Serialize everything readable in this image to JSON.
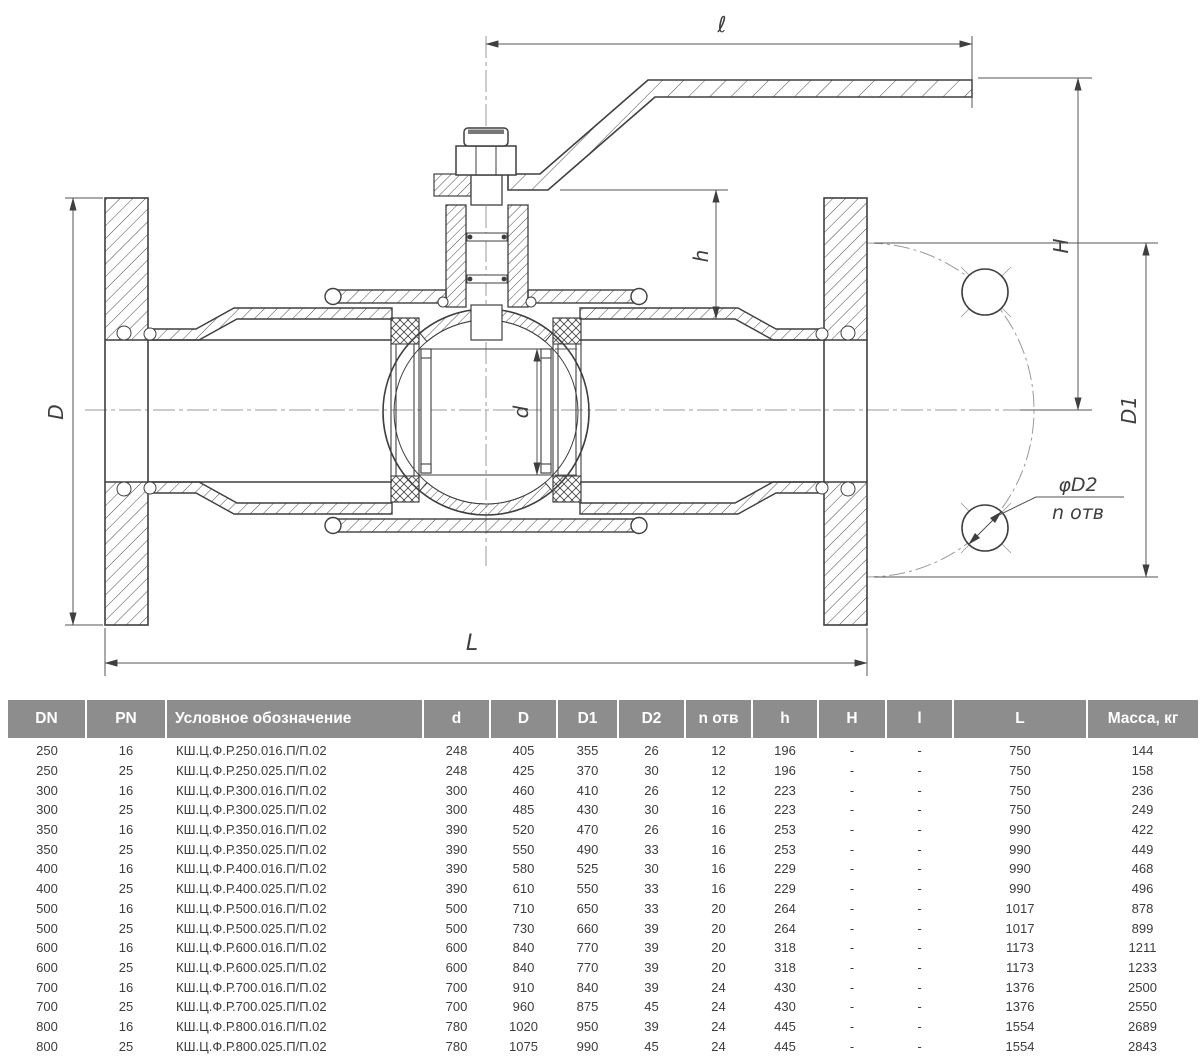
{
  "drawing": {
    "labels": {
      "l": "ℓ",
      "H": "H",
      "h": "h",
      "D": "D",
      "d": "d",
      "D1": "D1",
      "L": "L",
      "hole_note_1": "φD2",
      "hole_note_2": "n отв"
    },
    "line_color": "#3f3f3f",
    "dim_color": "#555555",
    "centerline_color": "#9a9a9a"
  },
  "table": {
    "header_bg": "#8d8d8d",
    "header_text_color": "#ffffff",
    "columns": [
      "DN",
      "PN",
      "Условное обозначение",
      "d",
      "D",
      "D1",
      "D2",
      "n отв",
      "h",
      "H",
      "l",
      "L",
      "Масса, кг"
    ],
    "rows": [
      [
        "250",
        "16",
        "КШ.Ц.Ф.Р.250.016.П/П.02",
        "248",
        "405",
        "355",
        "26",
        "12",
        "196",
        "-",
        "-",
        "750",
        "144"
      ],
      [
        "250",
        "25",
        "КШ.Ц.Ф.Р.250.025.П/П.02",
        "248",
        "425",
        "370",
        "30",
        "12",
        "196",
        "-",
        "-",
        "750",
        "158"
      ],
      [
        "300",
        "16",
        "КШ.Ц.Ф.Р.300.016.П/П.02",
        "300",
        "460",
        "410",
        "26",
        "12",
        "223",
        "-",
        "-",
        "750",
        "236"
      ],
      [
        "300",
        "25",
        "КШ.Ц.Ф.Р.300.025.П/П.02",
        "300",
        "485",
        "430",
        "30",
        "16",
        "223",
        "-",
        "-",
        "750",
        "249"
      ],
      [
        "350",
        "16",
        "КШ.Ц.Ф.Р.350.016.П/П.02",
        "390",
        "520",
        "470",
        "26",
        "16",
        "253",
        "-",
        "-",
        "990",
        "422"
      ],
      [
        "350",
        "25",
        "КШ.Ц.Ф.Р.350.025.П/П.02",
        "390",
        "550",
        "490",
        "33",
        "16",
        "253",
        "-",
        "-",
        "990",
        "449"
      ],
      [
        "400",
        "16",
        "КШ.Ц.Ф.Р.400.016.П/П.02",
        "390",
        "580",
        "525",
        "30",
        "16",
        "229",
        "-",
        "-",
        "990",
        "468"
      ],
      [
        "400",
        "25",
        "КШ.Ц.Ф.Р.400.025.П/П.02",
        "390",
        "610",
        "550",
        "33",
        "16",
        "229",
        "-",
        "-",
        "990",
        "496"
      ],
      [
        "500",
        "16",
        "КШ.Ц.Ф.Р.500.016.П/П.02",
        "500",
        "710",
        "650",
        "33",
        "20",
        "264",
        "-",
        "-",
        "1017",
        "878"
      ],
      [
        "500",
        "25",
        "КШ.Ц.Ф.Р.500.025.П/П.02",
        "500",
        "730",
        "660",
        "39",
        "20",
        "264",
        "-",
        "-",
        "1017",
        "899"
      ],
      [
        "600",
        "16",
        "КШ.Ц.Ф.Р.600.016.П/П.02",
        "600",
        "840",
        "770",
        "39",
        "20",
        "318",
        "-",
        "-",
        "1173",
        "1211"
      ],
      [
        "600",
        "25",
        "КШ.Ц.Ф.Р.600.025.П/П.02",
        "600",
        "840",
        "770",
        "39",
        "20",
        "318",
        "-",
        "-",
        "1173",
        "1233"
      ],
      [
        "700",
        "16",
        "КШ.Ц.Ф.Р.700.016.П/П.02",
        "700",
        "910",
        "840",
        "39",
        "24",
        "430",
        "-",
        "-",
        "1376",
        "2500"
      ],
      [
        "700",
        "25",
        "КШ.Ц.Ф.Р.700.025.П/П.02",
        "700",
        "960",
        "875",
        "45",
        "24",
        "430",
        "-",
        "-",
        "1376",
        "2550"
      ],
      [
        "800",
        "16",
        "КШ.Ц.Ф.Р.800.016.П/П.02",
        "780",
        "1020",
        "950",
        "39",
        "24",
        "445",
        "-",
        "-",
        "1554",
        "2689"
      ],
      [
        "800",
        "25",
        "КШ.Ц.Ф.Р.800.025.П/П.02",
        "780",
        "1075",
        "990",
        "45",
        "24",
        "445",
        "-",
        "-",
        "1554",
        "2843"
      ]
    ]
  }
}
